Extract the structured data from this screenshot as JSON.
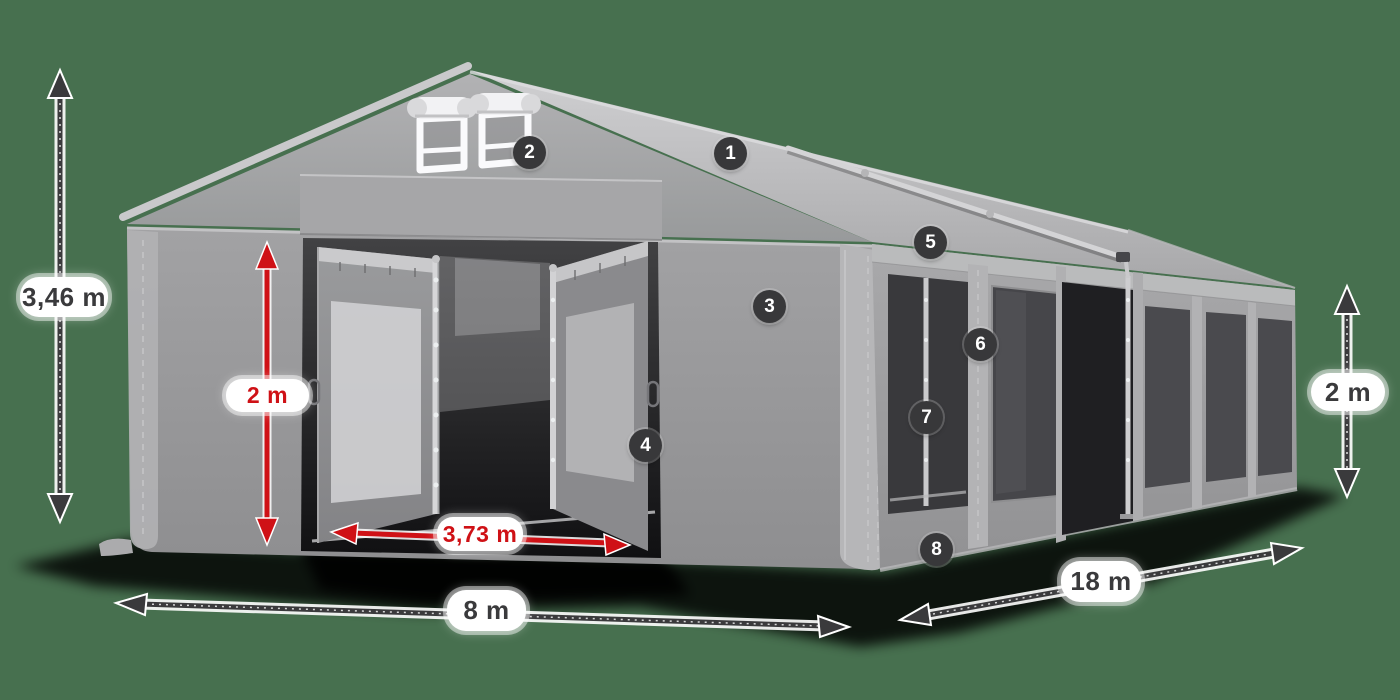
{
  "scene": {
    "subject": "Gray marquee tent 8 x 18 m, 3D product view with dimension arrows and numbered feature markers",
    "background_color": "#47704f",
    "tent_gray": "#9a9a9c",
    "accent_dark": "#3a3a3c",
    "accent_red": "#cf1116",
    "label_pill_color": "#ffffff"
  },
  "dimension_labels": {
    "total_height": "3,46 m",
    "entrance_height": "2 m",
    "entrance_width": "3,73 m",
    "span_width": "8 m",
    "length": "18 m",
    "side_height": "2 m"
  },
  "feature_markers": [
    {
      "number": "1"
    },
    {
      "number": "2"
    },
    {
      "number": "3"
    },
    {
      "number": "4"
    },
    {
      "number": "5"
    },
    {
      "number": "6"
    },
    {
      "number": "7"
    },
    {
      "number": "8"
    }
  ]
}
